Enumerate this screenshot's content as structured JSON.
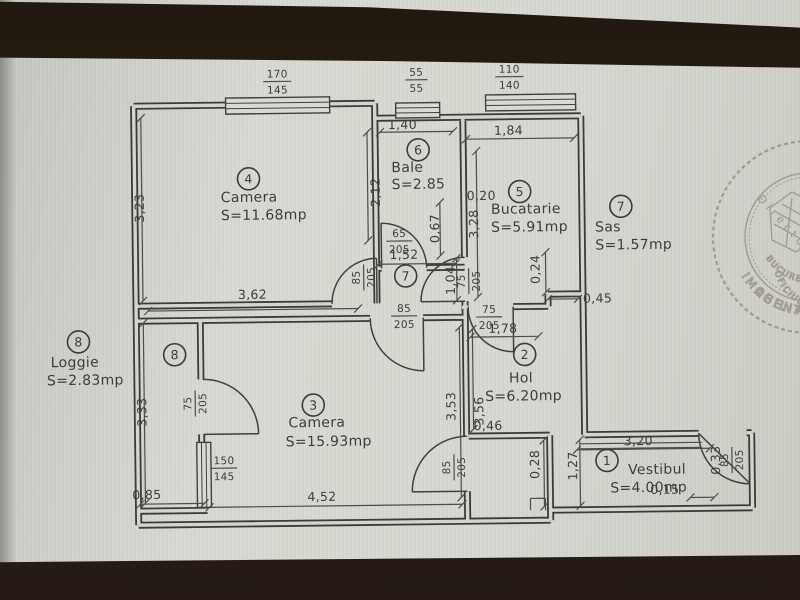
{
  "document_type": "apartment floor plan photo",
  "colors": {
    "paper": "#d3d5ce",
    "ink": "#3a3e3e",
    "photo_band": "#2e241e",
    "stamp_ink": "#7c6f63"
  },
  "rooms": {
    "vestibul": {
      "num": "1",
      "name": "Vestibul",
      "area": "S=4.00mp"
    },
    "hol": {
      "num": "2",
      "name": "Hol",
      "area": "S=6.20mp"
    },
    "camera3": {
      "num": "3",
      "name": "Camera",
      "area": "S=15.93mp"
    },
    "camera4": {
      "num": "4",
      "name": "Camera",
      "area": "S=11.68mp"
    },
    "bucatarie": {
      "num": "5",
      "name": "Bucatarie",
      "area": "S=5.91mp"
    },
    "baie": {
      "num": "6",
      "name": "Bale",
      "area": "S=2.85"
    },
    "sas": {
      "num": "7",
      "name": "Sas",
      "area": "S=1.57mp"
    },
    "loggie": {
      "num": "8",
      "name": "Loggie",
      "area": "S=2.83mp"
    }
  },
  "dims": {
    "room4_left": "3,23",
    "room4_bottom": "3,62",
    "room4_right": "2,12",
    "baie_top": "1,40",
    "sas_top": "1,52",
    "baie_door_side": "0,67",
    "bucatarie_top": "1,84",
    "bucatarie_left": "3,28",
    "bucatarie_jog": "0,20",
    "bucatarie_door": "1,04",
    "hol_step": "0,24",
    "hol_right_offset": "0,45",
    "hol_top": "1,78",
    "hol_left": "3,56",
    "camera3_right": "3,53",
    "camera3_bottom": "4,52",
    "hol_bottom": "0,46",
    "loggie_left": "3,33",
    "loggie_bottom": "0,85",
    "vestibul_top": "3,20",
    "vestibul_left": "1,27",
    "vestibul_offset": "0,28",
    "entry_offset": "0,15",
    "entry_side": "0,33"
  },
  "openings": {
    "window_room4": {
      "top": "170",
      "bottom": "145"
    },
    "window_baie": {
      "top": "55",
      "bottom": "55"
    },
    "window_bucatarie": {
      "top": "110",
      "bottom": "140"
    },
    "window_loggie": {
      "top": "150",
      "bottom": "145"
    },
    "door_room4": {
      "top": "85",
      "bottom": "205"
    },
    "door_baie": {
      "top": "65",
      "bottom": "205"
    },
    "door_bucatarie": {
      "top": "75",
      "bottom": "205"
    },
    "door_camera3_top": {
      "top": "85",
      "bottom": "205"
    },
    "door_hol": {
      "top": "75",
      "bottom": "205"
    },
    "door_camera3_bottom": {
      "top": "85",
      "bottom": "205"
    },
    "door_loggie": {
      "top": "75",
      "bottom": "205"
    },
    "door_entry": {
      "top": "85",
      "bottom": "205"
    }
  },
  "stamp": {
    "outer_top": "AGENTIA NATIONALA",
    "outer_bottom": "IMOBILIARA",
    "inner_top": "OFICIUL DE CADASTRU",
    "inner_bottom": "BUCURESTI",
    "center": "Director"
  }
}
